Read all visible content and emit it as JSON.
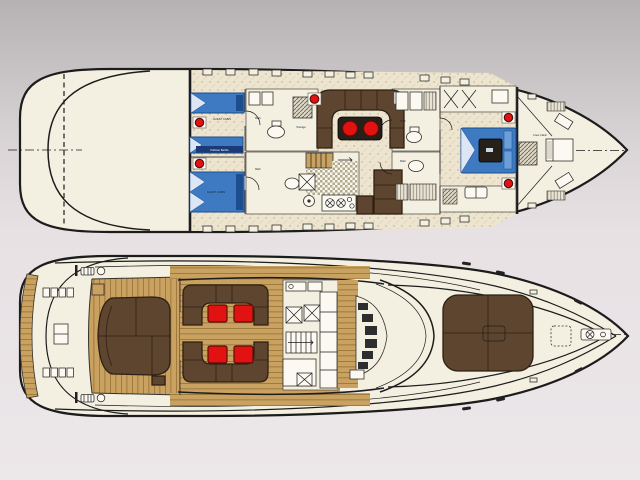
{
  "labels": {
    "guest_cabin_fwd": "GUEST CABIN",
    "guest_cabin_aft": "GUEST CABIN",
    "pullman_berths": "Pullman Berths",
    "storage": "Storage",
    "bath_guest_fwd": "Bath",
    "bath_guest_aft": "Bath",
    "bath_vip_fwd": "Bath",
    "bath_vip_aft": "Bath",
    "crew_cabin": "Crew Cabin"
  },
  "colors": {
    "bg_top": "#b6b2b4",
    "bg_bottom": "#ece7e9",
    "hull_fill": "#f3efe1",
    "outline": "#1c1c1c",
    "bed_blue": "#3d7ac2",
    "bed_blue_dark": "#1c4d8f",
    "sofa_brown": "#5e452f",
    "sofa_brown_dark": "#2f2012",
    "table_red": "#e31212",
    "table_red_dark": "#5a0f06",
    "teak": "#c9a160",
    "teak_seam": "#8e6a30",
    "speckle_base": "#ede5d0",
    "speckle_dot": "#b9a87c",
    "checker_dark": "#b2aa8e",
    "label_ink": "#1b2740"
  }
}
